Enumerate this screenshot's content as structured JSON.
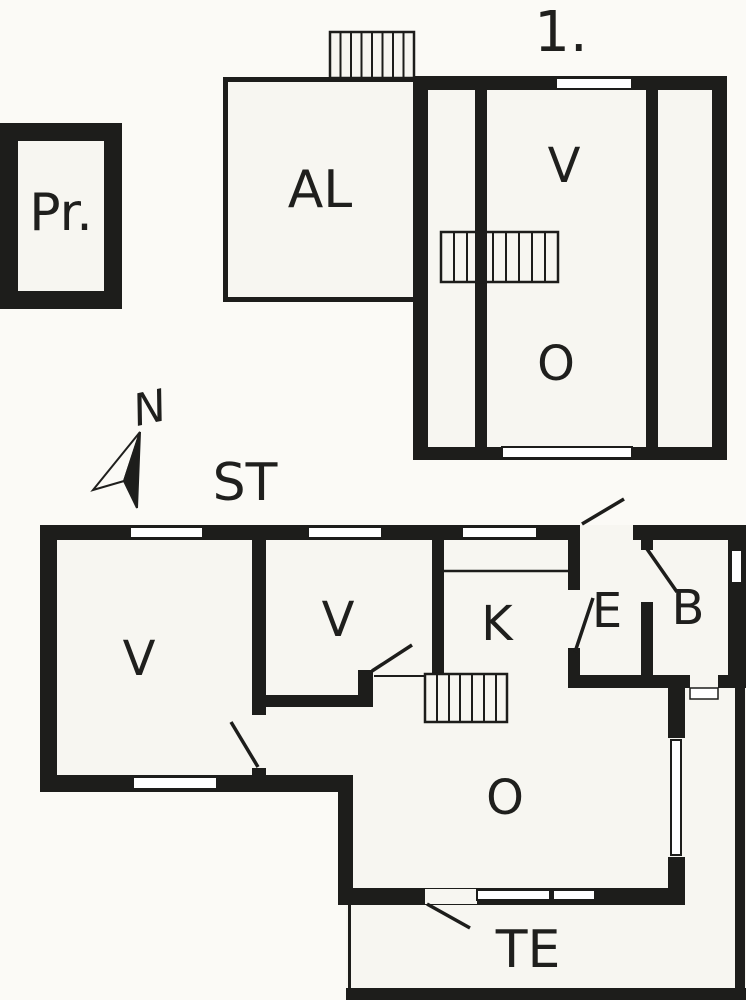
{
  "plan": {
    "outbuilding": {
      "label": "Pr."
    },
    "attic": {
      "room_label": "AL"
    },
    "upper_floor": {
      "floor_label": "1.",
      "rooms": [
        {
          "label": "V"
        },
        {
          "label": "O"
        }
      ]
    },
    "compass": {
      "north_label": "N"
    },
    "ground_floor": {
      "street_label": "ST",
      "terrace_label": "TE",
      "rooms": [
        {
          "label": "V"
        },
        {
          "label": "V"
        },
        {
          "label": "K"
        },
        {
          "label": "E"
        },
        {
          "label": "B"
        },
        {
          "label": "O"
        }
      ]
    }
  },
  "colors": {
    "wall": "#1d1d1b",
    "room_fill": "#f7f6f1",
    "window_fill": "#ffffff",
    "background": "#fbfaf6",
    "text": "#1f1f1d"
  }
}
